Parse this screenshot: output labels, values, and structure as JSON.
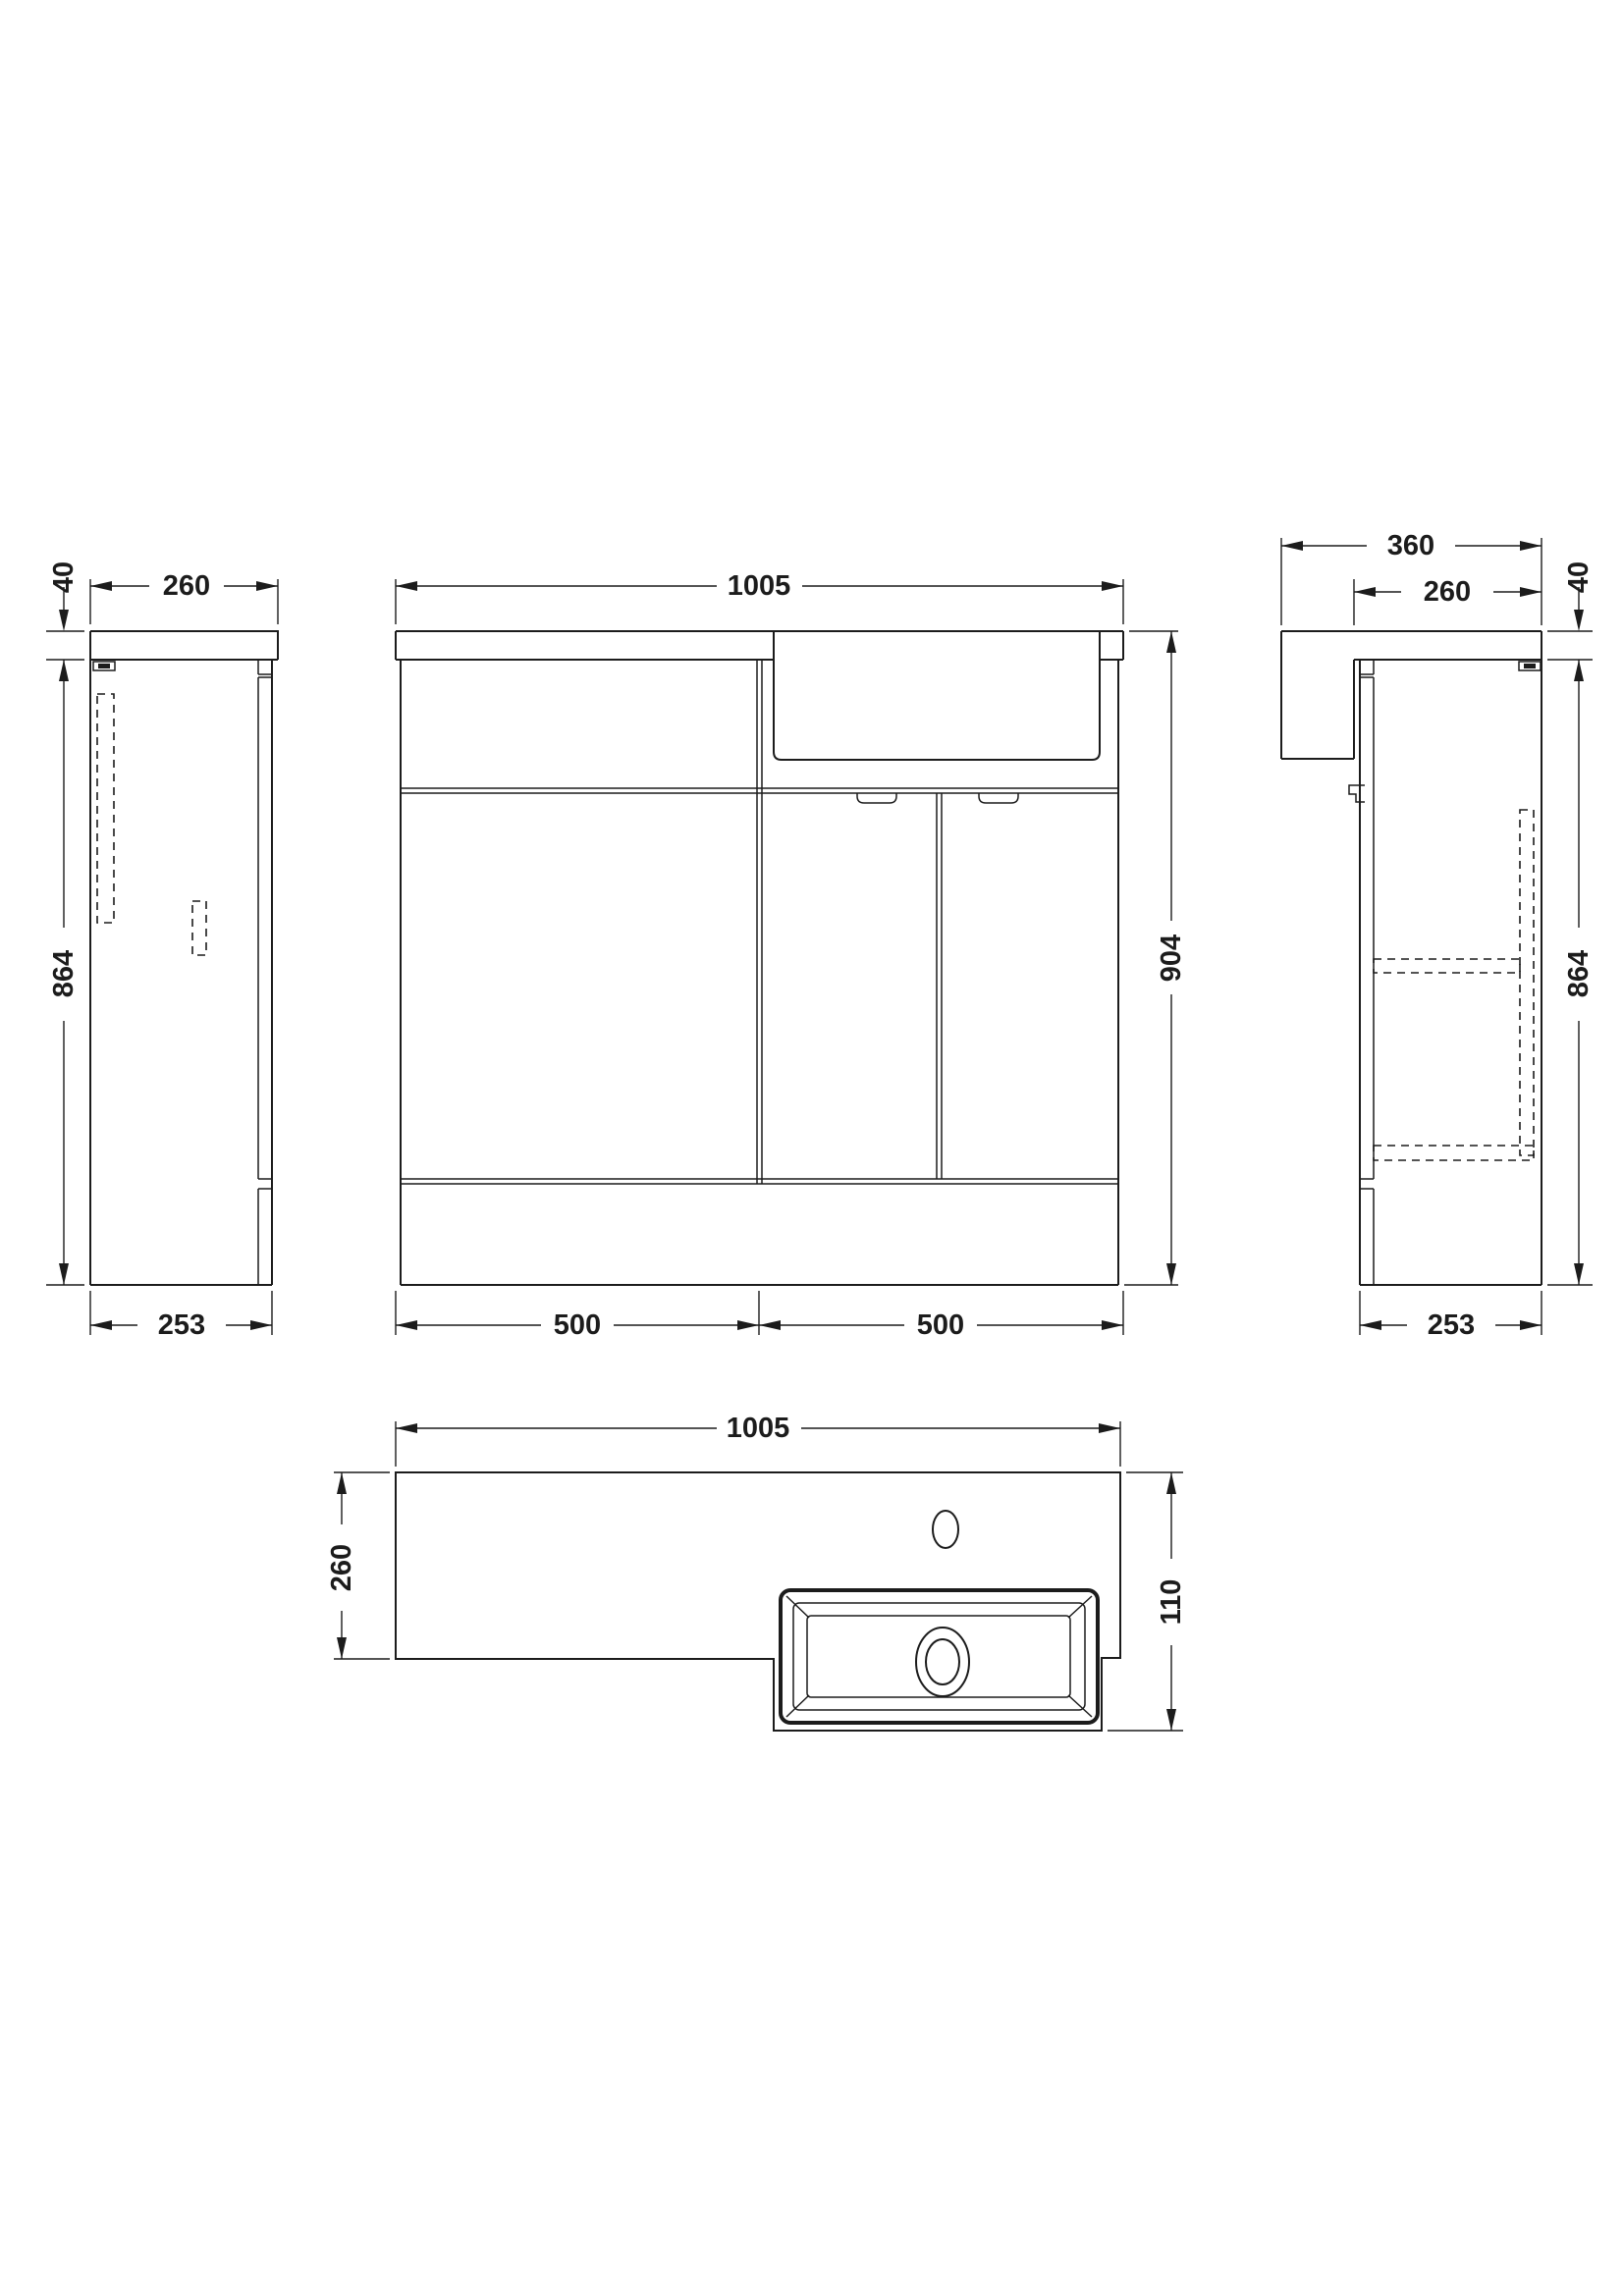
{
  "drawing": {
    "left_view": {
      "worktop_thickness": "40",
      "worktop_depth": "260",
      "cabinet_height": "864",
      "cabinet_depth": "253"
    },
    "front_view": {
      "overall_width": "1005",
      "overall_height": "904",
      "left_section_width": "500",
      "right_section_width": "500"
    },
    "right_view": {
      "overall_depth": "360",
      "worktop_depth": "260",
      "worktop_thickness": "40",
      "cabinet_height": "864",
      "cabinet_depth": "253"
    },
    "plan_view": {
      "overall_width": "1005",
      "worktop_depth": "260",
      "basin_projection": "110"
    }
  }
}
